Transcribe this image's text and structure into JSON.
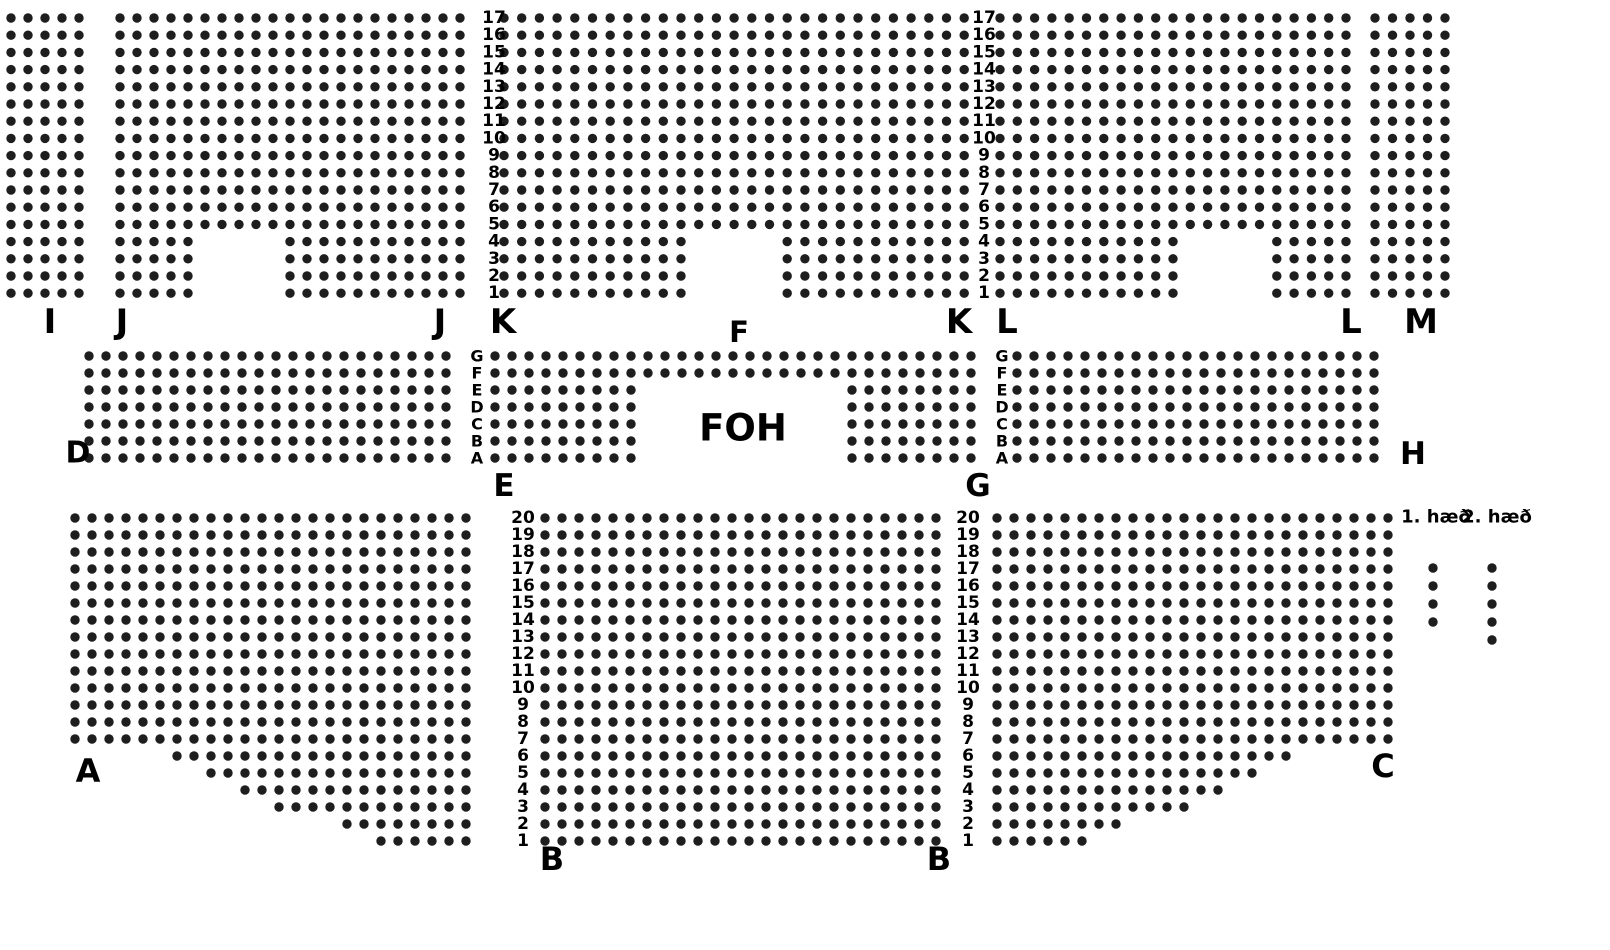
{
  "colors": {
    "seat": "#1e1e1e",
    "text": "#000000",
    "background": "#ffffff"
  },
  "legend": {
    "floors": [
      {
        "label": "1. hæð",
        "label_x": 1436,
        "label_y": 517,
        "dots_x": 1433,
        "dots_y": 568,
        "dots": 4,
        "dy": 18
      },
      {
        "label": "2. hæð",
        "label_x": 1497,
        "label_y": 517,
        "dots_x": 1492,
        "dots_y": 568,
        "dots": 5,
        "dy": 18
      }
    ],
    "font_size": 18
  },
  "seat_map": {
    "seat_radius": 4.7,
    "blocks": [
      {
        "section": "I",
        "x": 11,
        "y": 18,
        "cols": 5,
        "rows": 17,
        "dx": 17,
        "dy": 17.2
      },
      {
        "section": "J",
        "x": 120,
        "y": 18,
        "cols": 21,
        "rows": 17,
        "dx": 17,
        "dy": 17.2,
        "cuts": [
          {
            "rows": [
              13,
              16
            ],
            "cols": [
              5,
              9
            ]
          }
        ]
      },
      {
        "section": "K",
        "x": 504,
        "y": 18,
        "cols": 27,
        "rows": 17,
        "dx": 17.7,
        "dy": 17.2,
        "cuts": [
          {
            "rows": [
              13,
              16
            ],
            "cols": [
              11,
              15
            ]
          }
        ]
      },
      {
        "section": "L",
        "x": 1000,
        "y": 18,
        "cols": 21,
        "rows": 17,
        "dx": 17.3,
        "dy": 17.2,
        "cuts": [
          {
            "rows": [
              13,
              16
            ],
            "cols": [
              11,
              15
            ]
          }
        ]
      },
      {
        "section": "M",
        "x": 1375,
        "y": 18,
        "cols": 5,
        "rows": 17,
        "dx": 17.5,
        "dy": 17.2
      },
      {
        "section": "D",
        "x": 89,
        "y": 356,
        "cols": 22,
        "rows": 7,
        "dx": 17,
        "dy": 17
      },
      {
        "section": "F",
        "x": 495,
        "y": 356,
        "cols": 29,
        "rows": 2,
        "dx": 17,
        "dy": 17
      },
      {
        "section": "E",
        "x": 495,
        "y": 390,
        "cols": 9,
        "rows": 5,
        "dx": 17,
        "dy": 17
      },
      {
        "section": "G",
        "x": 852,
        "y": 390,
        "cols": 8,
        "rows": 5,
        "dx": 17,
        "dy": 17
      },
      {
        "section": "H",
        "x": 1017,
        "y": 356,
        "cols": 22,
        "rows": 7,
        "dx": 17,
        "dy": 17
      },
      {
        "section": "A",
        "x": 75,
        "y": 518,
        "cols": 24,
        "rows": 20,
        "dx": 17,
        "dy": 17,
        "cuts": [
          {
            "rows": [
              14,
              14
            ],
            "cols": [
              0,
              5
            ]
          },
          {
            "rows": [
              15,
              15
            ],
            "cols": [
              0,
              7
            ]
          },
          {
            "rows": [
              16,
              16
            ],
            "cols": [
              0,
              9
            ]
          },
          {
            "rows": [
              17,
              17
            ],
            "cols": [
              0,
              11
            ]
          },
          {
            "rows": [
              18,
              18
            ],
            "cols": [
              0,
              15
            ]
          },
          {
            "rows": [
              19,
              19
            ],
            "cols": [
              0,
              17
            ]
          }
        ]
      },
      {
        "section": "B",
        "x": 545,
        "y": 518,
        "cols": 24,
        "rows": 20,
        "dx": 17,
        "dy": 17
      },
      {
        "section": "C",
        "x": 997,
        "y": 518,
        "cols": 24,
        "rows": 20,
        "dx": 17,
        "dy": 17,
        "cuts": [
          {
            "rows": [
              14,
              14
            ],
            "cols": [
              18,
              23
            ]
          },
          {
            "rows": [
              15,
              15
            ],
            "cols": [
              16,
              23
            ]
          },
          {
            "rows": [
              16,
              16
            ],
            "cols": [
              14,
              23
            ]
          },
          {
            "rows": [
              17,
              17
            ],
            "cols": [
              12,
              23
            ]
          },
          {
            "rows": [
              18,
              18
            ],
            "cols": [
              8,
              23
            ]
          },
          {
            "rows": [
              19,
              19
            ],
            "cols": [
              6,
              23
            ]
          }
        ]
      }
    ],
    "axis_columns": [
      {
        "name": "top-row-numbers-left",
        "x": 494,
        "y": 18,
        "dy": 17.2,
        "size": 17,
        "values": [
          "17",
          "16",
          "15",
          "14",
          "13",
          "12",
          "11",
          "10",
          "9",
          "8",
          "7",
          "6",
          "5",
          "4",
          "3",
          "2",
          "1"
        ]
      },
      {
        "name": "top-row-numbers-right",
        "x": 984,
        "y": 18,
        "dy": 17.2,
        "size": 17,
        "values": [
          "17",
          "16",
          "15",
          "14",
          "13",
          "12",
          "11",
          "10",
          "9",
          "8",
          "7",
          "6",
          "5",
          "4",
          "3",
          "2",
          "1"
        ]
      },
      {
        "name": "middle-row-letters-left",
        "x": 477,
        "y": 356,
        "dy": 17,
        "size": 16,
        "values": [
          "G",
          "F",
          "E",
          "D",
          "C",
          "B",
          "A"
        ]
      },
      {
        "name": "middle-row-letters-right",
        "x": 1002,
        "y": 356,
        "dy": 17,
        "size": 16,
        "values": [
          "G",
          "F",
          "E",
          "D",
          "C",
          "B",
          "A"
        ]
      },
      {
        "name": "bottom-row-numbers-left",
        "x": 523,
        "y": 518,
        "dy": 17,
        "size": 17,
        "values": [
          "20",
          "19",
          "18",
          "17",
          "16",
          "15",
          "14",
          "13",
          "12",
          "11",
          "10",
          "9",
          "8",
          "7",
          "6",
          "5",
          "4",
          "3",
          "2",
          "1"
        ]
      },
      {
        "name": "bottom-row-numbers-right",
        "x": 968,
        "y": 518,
        "dy": 17,
        "size": 17,
        "values": [
          "20",
          "19",
          "18",
          "17",
          "16",
          "15",
          "14",
          "13",
          "12",
          "11",
          "10",
          "9",
          "8",
          "7",
          "6",
          "5",
          "4",
          "3",
          "2",
          "1"
        ]
      }
    ],
    "labels": [
      {
        "text": "I",
        "x": 50,
        "y": 322,
        "size": 34
      },
      {
        "text": "J",
        "x": 122,
        "y": 322,
        "size": 34
      },
      {
        "text": "J",
        "x": 440,
        "y": 322,
        "size": 34
      },
      {
        "text": "K",
        "x": 503,
        "y": 322,
        "size": 34
      },
      {
        "text": "F",
        "x": 739,
        "y": 332,
        "size": 29
      },
      {
        "text": "K",
        "x": 959,
        "y": 322,
        "size": 34
      },
      {
        "text": "L",
        "x": 1007,
        "y": 322,
        "size": 34
      },
      {
        "text": "L",
        "x": 1351,
        "y": 322,
        "size": 34
      },
      {
        "text": "M",
        "x": 1421,
        "y": 322,
        "size": 34
      },
      {
        "text": "D",
        "x": 78,
        "y": 453,
        "size": 30
      },
      {
        "text": "E",
        "x": 504,
        "y": 486,
        "size": 31
      },
      {
        "text": "FOH",
        "x": 743,
        "y": 428,
        "size": 37
      },
      {
        "text": "G",
        "x": 978,
        "y": 486,
        "size": 31
      },
      {
        "text": "H",
        "x": 1413,
        "y": 454,
        "size": 31
      },
      {
        "text": "A",
        "x": 88,
        "y": 771,
        "size": 32
      },
      {
        "text": "B",
        "x": 552,
        "y": 859,
        "size": 32
      },
      {
        "text": "B",
        "x": 939,
        "y": 859,
        "size": 32
      },
      {
        "text": "C",
        "x": 1383,
        "y": 766,
        "size": 32
      }
    ]
  }
}
